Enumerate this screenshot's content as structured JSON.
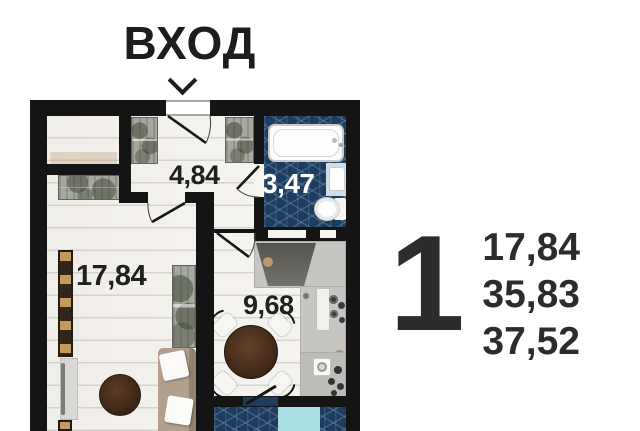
{
  "entrance": {
    "label": "ВХОД",
    "arrow_icon": "chevron-down"
  },
  "floor_plan": {
    "rooms": [
      {
        "id": "hallway",
        "area": "4,84"
      },
      {
        "id": "bathroom",
        "area": "3,47"
      },
      {
        "id": "living_room",
        "area": "17,84"
      },
      {
        "id": "kitchen_dining",
        "area": "9,68"
      }
    ]
  },
  "apartment_info": {
    "rooms_count": "1",
    "area_values": [
      "17,84",
      "35,83",
      "37,52"
    ]
  },
  "colors": {
    "wall": "#141414",
    "floor_plank": "#f5f3ef",
    "plank_line": "#d9d5ce",
    "bathroom_tile": "#1d3c5e",
    "tile_line": "#7aa2c6",
    "balcony_accent": "#a9dde4",
    "label_dark": "#202020",
    "label_light": "#ffffff",
    "info_text": "#2c2c2c"
  }
}
